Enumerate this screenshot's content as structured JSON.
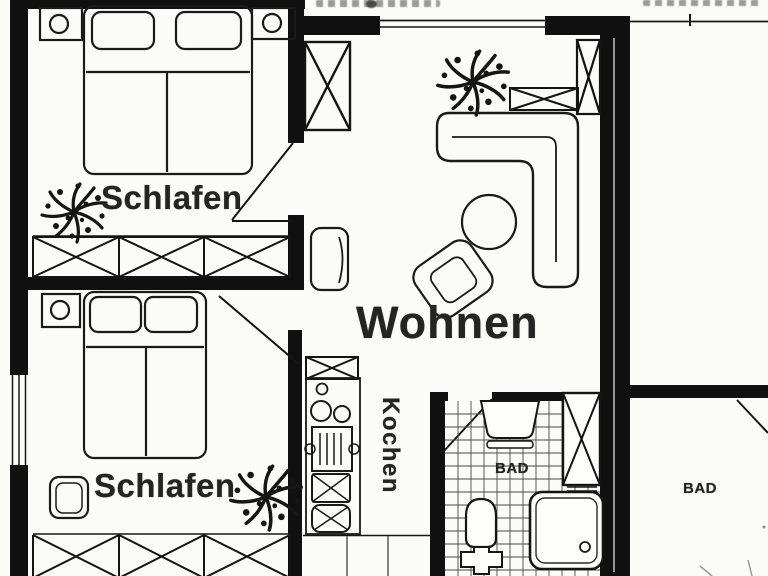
{
  "rooms": {
    "bedroom_top": {
      "label": "Schlafen"
    },
    "bedroom_bottom": {
      "label": "Schlafen"
    },
    "living_room": {
      "label": "Wohnen"
    },
    "kitchen": {
      "label": "Kochen"
    },
    "bathroom_center": {
      "label": "BAD"
    },
    "bathroom_right": {
      "label": "BAD"
    }
  },
  "colors": {
    "ink": "#141414",
    "paper": "#fbfbf9",
    "label_text": "#242424"
  }
}
